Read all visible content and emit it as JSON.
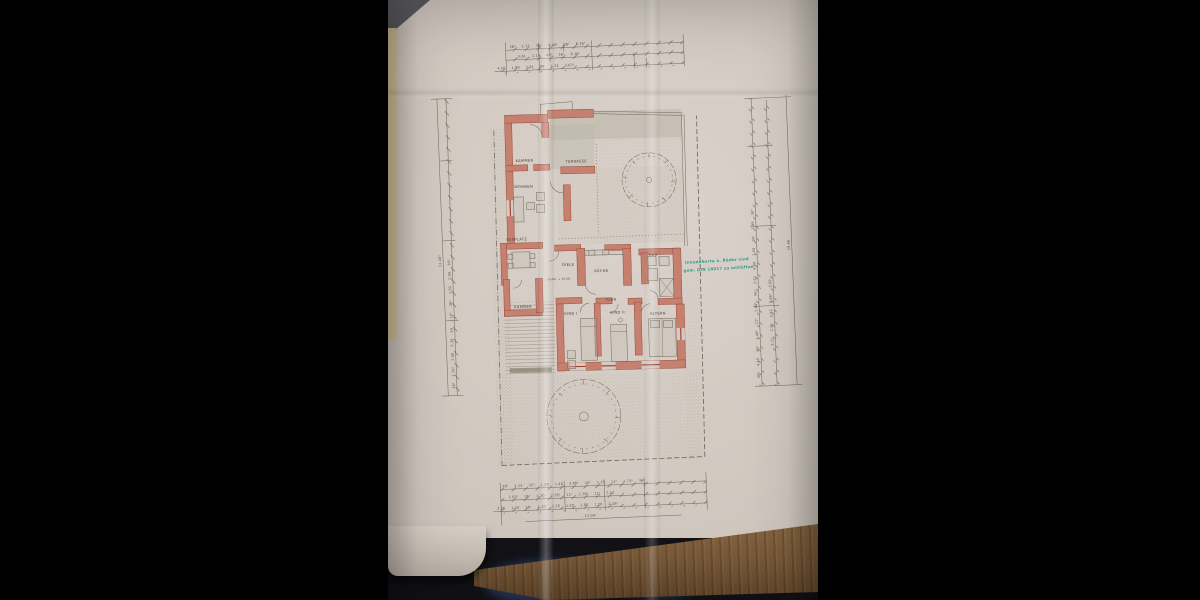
{
  "photo": {
    "background": "#000000",
    "paper_color": "#d3cac2",
    "wood_color": "#7a5a38",
    "wall_color": "#c5806f",
    "note_color": "#2f9c8c"
  },
  "plan": {
    "rooms": [
      {
        "label": "KAMMER"
      },
      {
        "label": "TERRASSE"
      },
      {
        "label": "WOHNEN"
      },
      {
        "label": "ESSPLATZ"
      },
      {
        "label": "DIELE"
      },
      {
        "label": "GARD. + SCHR."
      },
      {
        "label": "KÜCHE"
      },
      {
        "label": "BAD"
      },
      {
        "label": "KAMMER"
      },
      {
        "label": "KIND I"
      },
      {
        "label": "FLUR"
      },
      {
        "label": "KIND II"
      },
      {
        "label": "ELTERN"
      }
    ],
    "note": {
      "line1": "Innenaborte u. Bäder sind",
      "line2": "gem. DIN 18017 zu entlüften"
    },
    "dims": {
      "top": {
        "row1": [
          "36⁵",
          "2.73",
          "36⁵",
          "4.48⁵",
          "36⁵",
          "6.36⁵"
        ],
        "row2": [
          "3.61",
          "1.19",
          "40⁵",
          "36⁵",
          "8.16⁵"
        ],
        "row3": [
          "4.20",
          "1.99",
          "2.61",
          "99",
          "1.32",
          "3.63⁵"
        ]
      },
      "bottom": {
        "row1": [
          "36⁵",
          "2.14",
          "32⁵",
          "1.20",
          "1.48",
          "3.68⁵",
          "43⁵",
          "1.20",
          "11⁵",
          "2.73⁵",
          "36⁵"
        ],
        "row2": [
          "1.03⁵",
          "36⁵",
          "1.20",
          "2.28⁵",
          "11⁵",
          "2.28⁵",
          "11⁵",
          "3.50"
        ],
        "row3": [
          "2.76",
          "1.20",
          "36⁵",
          "1.20",
          "1.20",
          "1.20",
          "1.80",
          "1.20",
          "2.18⁵"
        ],
        "total": "13.09⁵"
      },
      "left": {
        "inner": [
          "36⁵",
          "1.10⁵",
          "2.90",
          "5.38",
          "20",
          "1.10⁵",
          "36⁵",
          "1.82",
          "1.98",
          "36⁵"
        ],
        "total": "11.48⁵"
      },
      "right": {
        "inner": [
          "36⁵",
          "4.45",
          "36⁵",
          "1.48⁵",
          "11⁵",
          "1.48⁵",
          "36⁵",
          "2.62",
          "4.90",
          "1.50",
          "36⁵",
          "1.98",
          "36⁵"
        ],
        "mid": [
          "9.11",
          "2.36",
          "2.92",
          "8.66⁵",
          "2.60"
        ],
        "total": "19.66"
      }
    }
  }
}
